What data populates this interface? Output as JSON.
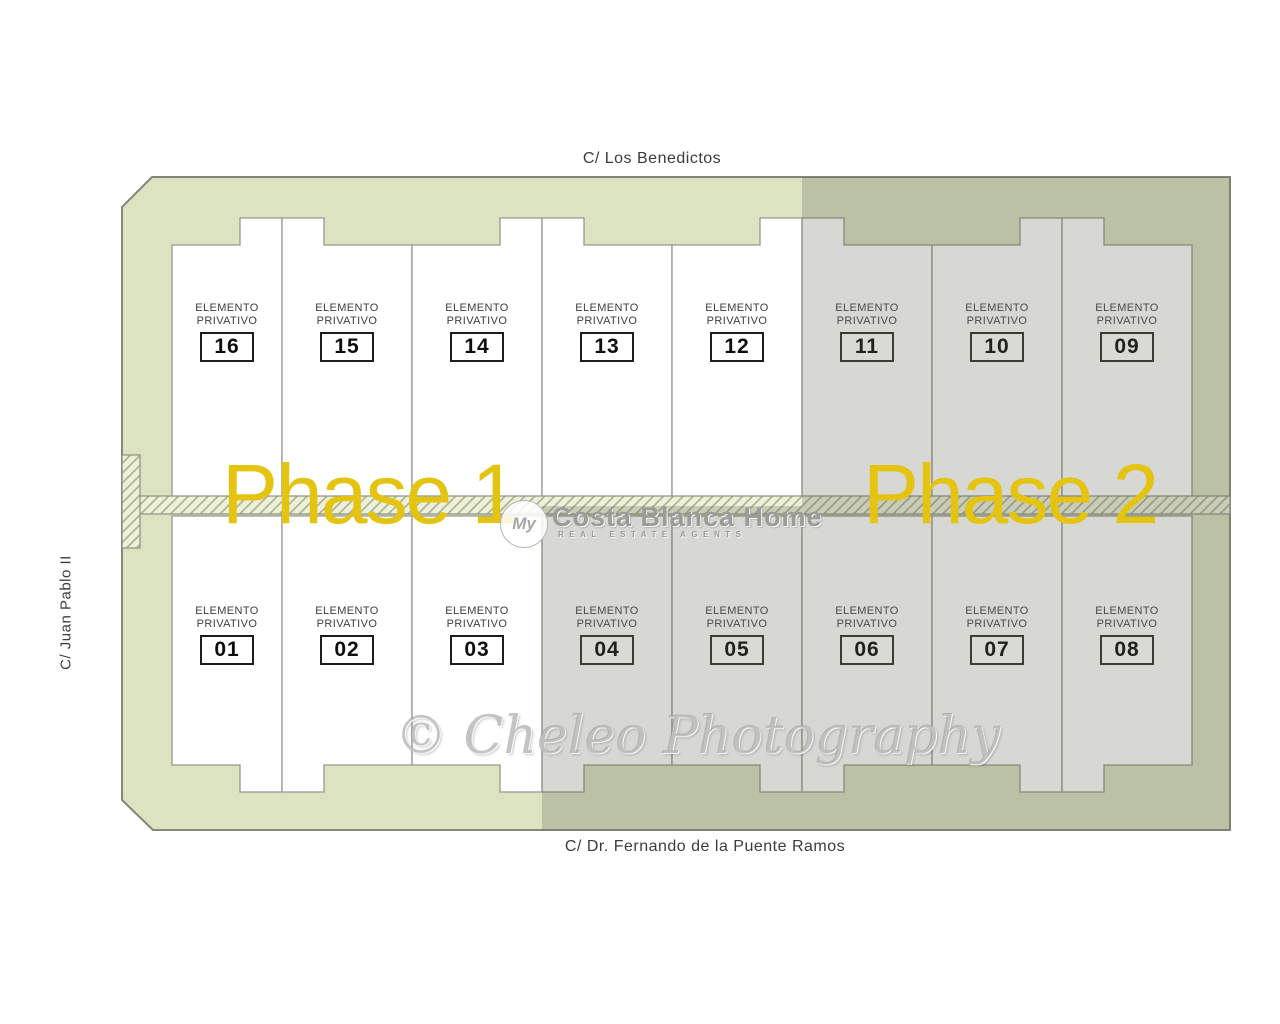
{
  "title": "Residential site plan — Elemento Privativo plots 01-16",
  "streets": {
    "top": "C/ Los Benedictos",
    "bottom": "C/ Dr. Fernando de la Puente Ramos",
    "left": "C/ Juan Pablo II"
  },
  "phase_labels": {
    "phase1": "Phase 1",
    "phase2": "Phase 2"
  },
  "plot_label": {
    "line1": "ELEMENTO",
    "line2": "PRIVATIVO"
  },
  "plots": {
    "top_row": [
      {
        "number": "16",
        "phase": "Phase 1"
      },
      {
        "number": "15",
        "phase": "Phase 1"
      },
      {
        "number": "14",
        "phase": "Phase 1"
      },
      {
        "number": "13",
        "phase": "Phase 1"
      },
      {
        "number": "12",
        "phase": "Phase 1"
      },
      {
        "number": "11",
        "phase": "Phase 2"
      },
      {
        "number": "10",
        "phase": "Phase 2"
      },
      {
        "number": "09",
        "phase": "Phase 2"
      }
    ],
    "bottom_row": [
      {
        "number": "01",
        "phase": "Phase 1"
      },
      {
        "number": "02",
        "phase": "Phase 1"
      },
      {
        "number": "03",
        "phase": "Phase 1"
      },
      {
        "number": "04",
        "phase": "Phase 2"
      },
      {
        "number": "05",
        "phase": "Phase 2"
      },
      {
        "number": "06",
        "phase": "Phase 2"
      },
      {
        "number": "07",
        "phase": "Phase 2"
      },
      {
        "number": "08",
        "phase": "Phase 2"
      }
    ]
  },
  "watermarks": {
    "agency_logo_text": "My",
    "agency_title": "Costa Blanca Home",
    "agency_subtitle": "REAL ESTATE AGENTS",
    "photography": "© Cheleo Photography"
  },
  "colors": {
    "phase_accent_yellow": "#e4c411",
    "sage_border_phase1": "#dbe3c0",
    "plot_fill_phase1": "#ffffff",
    "plot_fill_phase2": "#d4d4d1",
    "sage_border_phase2": "#c2c8ad",
    "driveway_band_bg": "#edf1d8",
    "outline_gray": "#8f9083",
    "label_text": "#3d3d3b"
  }
}
